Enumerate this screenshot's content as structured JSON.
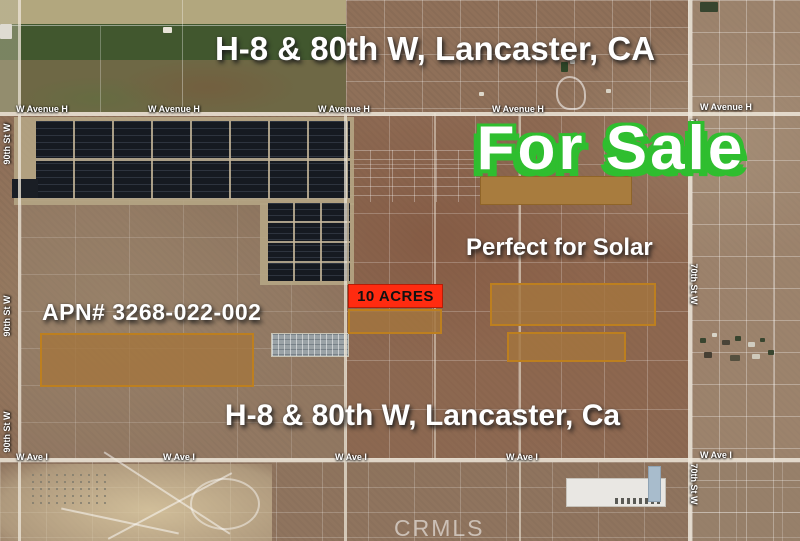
{
  "listing": {
    "title_top": "H-8 & 80th W, Lancaster, CA",
    "title_bottom": "H-8 & 80th W, Lancaster, Ca",
    "for_sale": "For Sale",
    "pitch": "Perfect for Solar",
    "apn": "APN# 3268-022-002",
    "acres_badge": "10 ACRES"
  },
  "streets": {
    "avenue_h": "W Avenue H",
    "ave_i": "W Ave I",
    "st_90": "90th St W",
    "st_70": "70th St W"
  },
  "watermark": "CRMLS",
  "colors": {
    "for_sale_green": "#2fbe2f",
    "acres_red": "#ff2b10",
    "parcel_fill": "#a87c3e",
    "parcel_fill_translucent": "rgba(163,117,62,0.82)",
    "parcel_border": "#bd7f1f"
  }
}
